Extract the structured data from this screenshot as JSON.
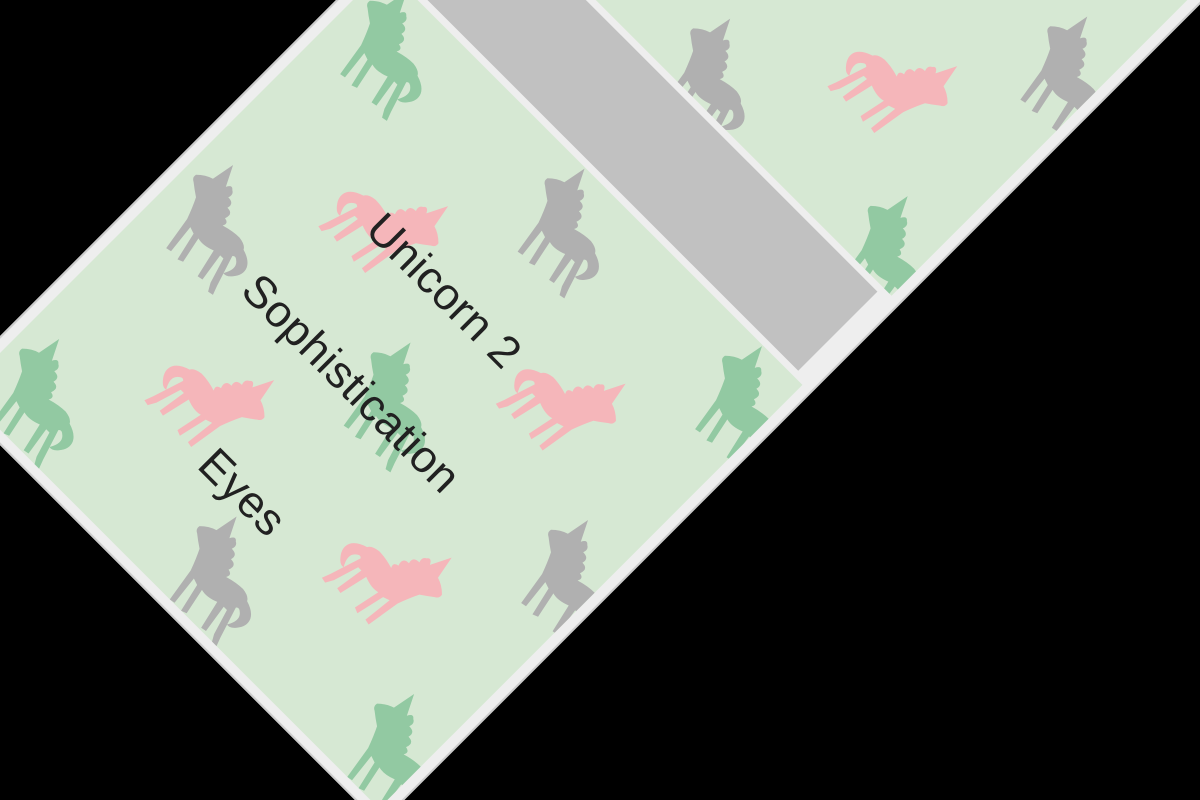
{
  "window": {
    "background": "#000000"
  },
  "page": {
    "background": "#eeeeee",
    "edge_color": "#cccccc",
    "rotation_deg": 45,
    "section_background": "#d6e8d3"
  },
  "divider_band": {
    "color": "#c1c1c1"
  },
  "card": {
    "title": "Unicorn 2",
    "attributes": [
      "Sophistication",
      "Eyes"
    ],
    "text_color": "#212121"
  },
  "pattern": {
    "icon": "unicorn-icon",
    "colors": {
      "pink": "#f5b6ba",
      "green": "#92c9a2",
      "gray": "#b0b0b0"
    },
    "unicorn_size": 114,
    "sections": [
      {
        "id": "section-top",
        "width": 590,
        "height": 527,
        "v_start": -7,
        "row_step": 127,
        "u_a": 62,
        "u_p": 190,
        "col_step": 251
      },
      {
        "id": "unicorn-card",
        "width": 590,
        "height": 599,
        "v_start": 57,
        "row_step": 123,
        "u_a": 65,
        "u_p": 180,
        "col_step": 251
      }
    ]
  }
}
